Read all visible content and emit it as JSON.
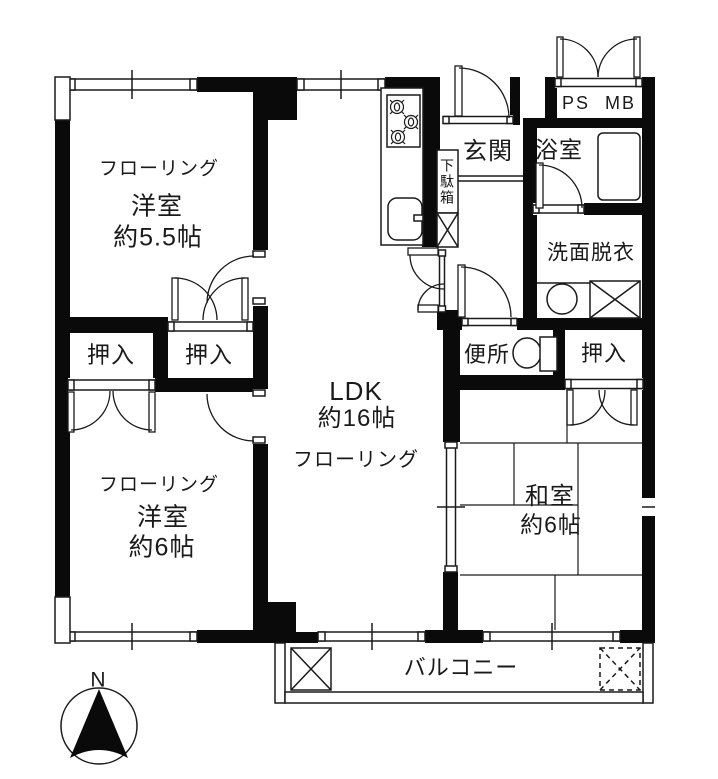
{
  "rooms": {
    "bedroom1": {
      "flooring_label": "フローリング",
      "name": "洋室",
      "size": "約5.5帖"
    },
    "bedroom2": {
      "flooring_label": "フローリング",
      "name": "洋室",
      "size": "約6帖"
    },
    "ldk": {
      "name": "LDK",
      "size": "約16帖",
      "flooring_label": "フローリング"
    },
    "washitsu": {
      "name": "和室",
      "size": "約6帖"
    },
    "genkan": {
      "name": "玄関"
    },
    "bathroom": {
      "name": "浴室"
    },
    "washroom": {
      "name": "洗面脱衣"
    },
    "toilet": {
      "name": "便所"
    },
    "balcony": {
      "name": "バルコニー"
    }
  },
  "storage": {
    "oshiire1": "押入",
    "oshiire2": "押入",
    "oshiire3": "押入",
    "getabako": "下駄箱",
    "ps_mb": "PS MB"
  },
  "compass": {
    "north": "N"
  },
  "fixtures": {
    "kitchen_stove": "gas-stove-3-burner",
    "kitchen_sink": "kitchen-sink",
    "bathtub": "bathtub",
    "wash_basin": "wash-basin",
    "washing_machine_pan": "washing-machine-pan-x-box",
    "toilet_bowl": "toilet-bowl",
    "balcony_hatch": "dashed-x-hatch",
    "north_arrow": "north-compass-arrow"
  },
  "colors": {
    "wall": "#0a0a0a",
    "line": "#1a1a1a",
    "background": "#ffffff"
  }
}
